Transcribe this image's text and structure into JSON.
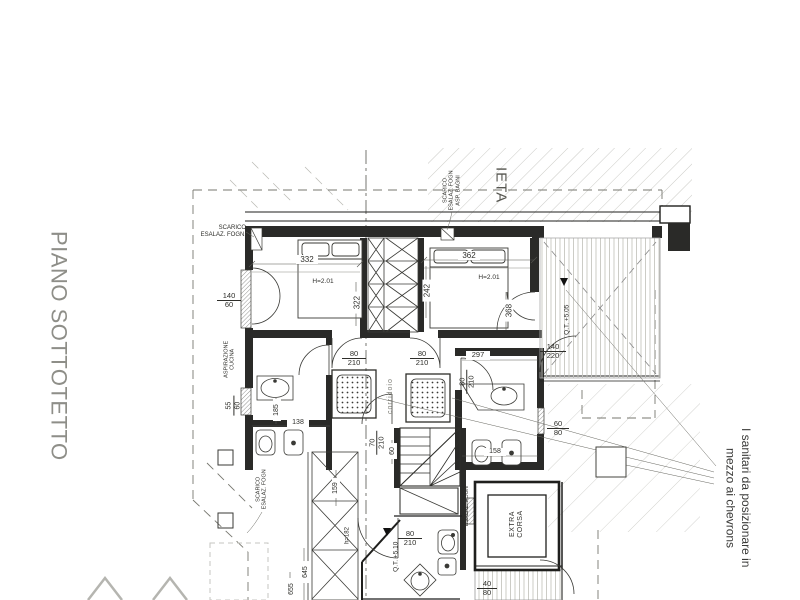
{
  "titles": {
    "floor_title": "PIANO SOTTOTETTO",
    "cropped_word": "IETA",
    "note": "I sanitari da posizionare in\nmezzo ai chevrons"
  },
  "annotations": {
    "scarico_left": "SCARICO\nESALAZ. FOGN.",
    "scarico_top": "SCARICO\nESALAZ. FOGN\nASP. BAGNI",
    "aspirazione": "ASPIRAZIONE\nCUCINA",
    "scarico_bottom": "SCARICO\nESALAZ. FOGN",
    "esalaz_lift": "ESALAZ. FOGN",
    "corridoio": "corridoio",
    "extra_corsa": "EXTRA\nCORSA",
    "h_bed1": "H=2.01",
    "h_bed2": "H=2.01",
    "h_wardrobe": "h=182",
    "level_terrace": "Q.T. +5.05",
    "level_bath": "Q.T. +5.10"
  },
  "dimensions": {
    "bed1_width": "332",
    "bed1_depth": "322",
    "bed2_width": "362",
    "bed2_depth": "242",
    "bed2_wall": "368",
    "bath2_width": "297",
    "bath1_width": "138",
    "bath1_depth": "185",
    "bath2_fixtures": "158",
    "stair_width": "60",
    "wardrobe_depth": "159",
    "outer_a": "645",
    "outer_b": "655"
  },
  "openings": {
    "win_bed1": {
      "w": "140",
      "h": "60"
    },
    "win_bath1": {
      "w": "55",
      "h": "60"
    },
    "door_corr_left": {
      "w": "80",
      "h": "210"
    },
    "door_corr_right": {
      "w": "80",
      "h": "210"
    },
    "door_bath2": {
      "w": "80",
      "h": "210"
    },
    "door_hall": {
      "w": "70",
      "h": "210"
    },
    "door_terrace": {
      "w": "140",
      "h": "220"
    },
    "win_bath2": {
      "w": "60",
      "h": "80"
    },
    "door_bath3": {
      "w": "80",
      "h": "210"
    },
    "win_terrace2": {
      "w": "40",
      "h": "80"
    }
  }
}
